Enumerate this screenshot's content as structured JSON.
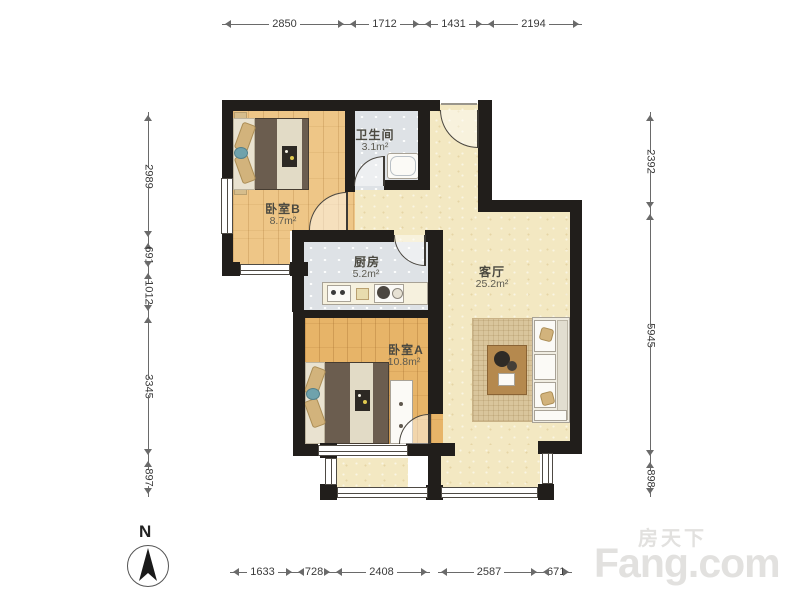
{
  "watermark": {
    "brand_cn": "房天下",
    "brand_en": "Fang.com"
  },
  "compass": {
    "label": "N"
  },
  "rooms": {
    "bedroomB": {
      "name": "卧室B",
      "area": "8.7m²"
    },
    "bathroom": {
      "name": "卫生间",
      "area": "3.1m²"
    },
    "kitchen": {
      "name": "厨房",
      "area": "5.2m²"
    },
    "bedroomA": {
      "name": "卧室A",
      "area": "10.8m²"
    },
    "living": {
      "name": "客厅",
      "area": "25.2m²"
    }
  },
  "dimensions_mm": {
    "top": [
      "2850",
      "1712",
      "1431",
      "2194"
    ],
    "left": [
      "2989",
      "691",
      "1012",
      "3345",
      "897"
    ],
    "right": [
      "2392",
      "5945",
      "898"
    ],
    "bottom": [
      "1633",
      "728",
      "2408",
      "2587",
      "671"
    ]
  },
  "palette": {
    "wall": "#211e1b",
    "wood_floor_a": "#e7b468",
    "wood_floor_b": "#eec687",
    "cream_floor": "#f3e8c2",
    "tile_floor": "#dee2e6",
    "rug": "#d9c59c",
    "watermark_gray": "#e2e1df"
  }
}
